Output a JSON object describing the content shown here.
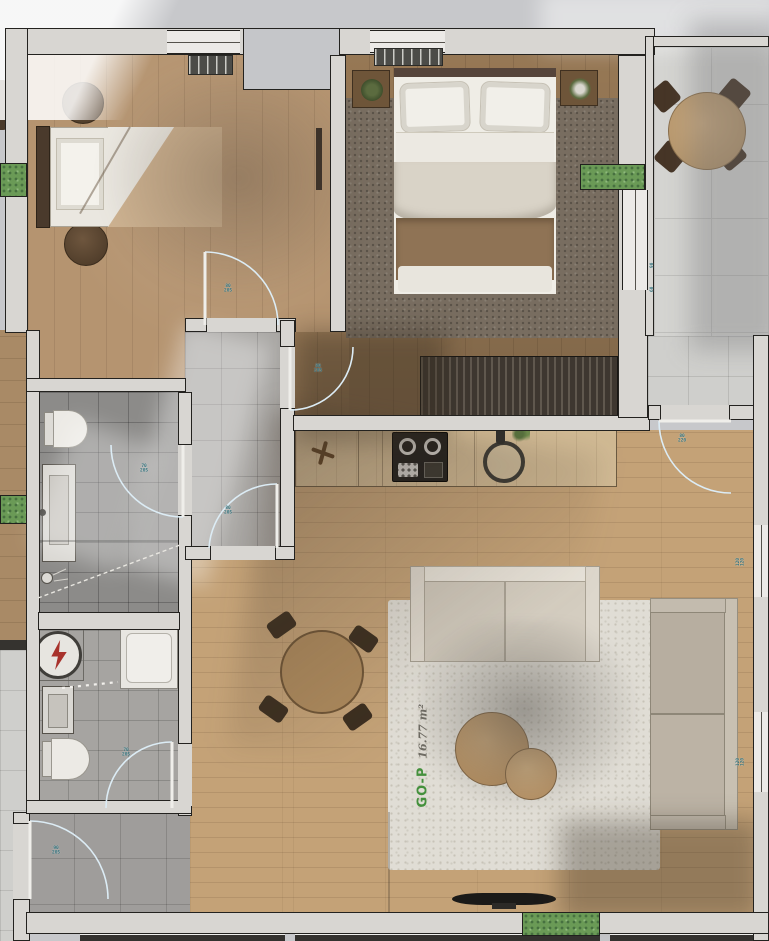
{
  "living_label": {
    "code": "GO-P",
    "area": "16.77 m²"
  },
  "tags": {
    "bedroom1_door": [
      "80",
      "205"
    ],
    "bedroom2_door": [
      "80",
      "205"
    ],
    "hall_door": [
      "80",
      "205"
    ],
    "bath1_door": [
      "70",
      "205"
    ],
    "bath2_door": [
      "70",
      "205"
    ],
    "entry_door": [
      "90",
      "205"
    ],
    "balcony_door": [
      "80",
      "220"
    ],
    "window_right_upper": [
      "120",
      "120"
    ],
    "window_right_lower": [
      "120",
      "120"
    ],
    "balcony_edge_a": [
      "90"
    ],
    "balcony_edge_b": [
      "60"
    ]
  },
  "colors": {
    "planter_green": "#6a9a56",
    "tag_teal": "#2f6e78",
    "label_green": "#44903c",
    "washer_accent_red": "#a8322c",
    "wall_fill": "#d8d6d2",
    "wall_edge": "#23221f",
    "wood_living": "#c4a277",
    "wood_bedroom": "#b59470",
    "tile_balcony": "#d4d4d1"
  }
}
